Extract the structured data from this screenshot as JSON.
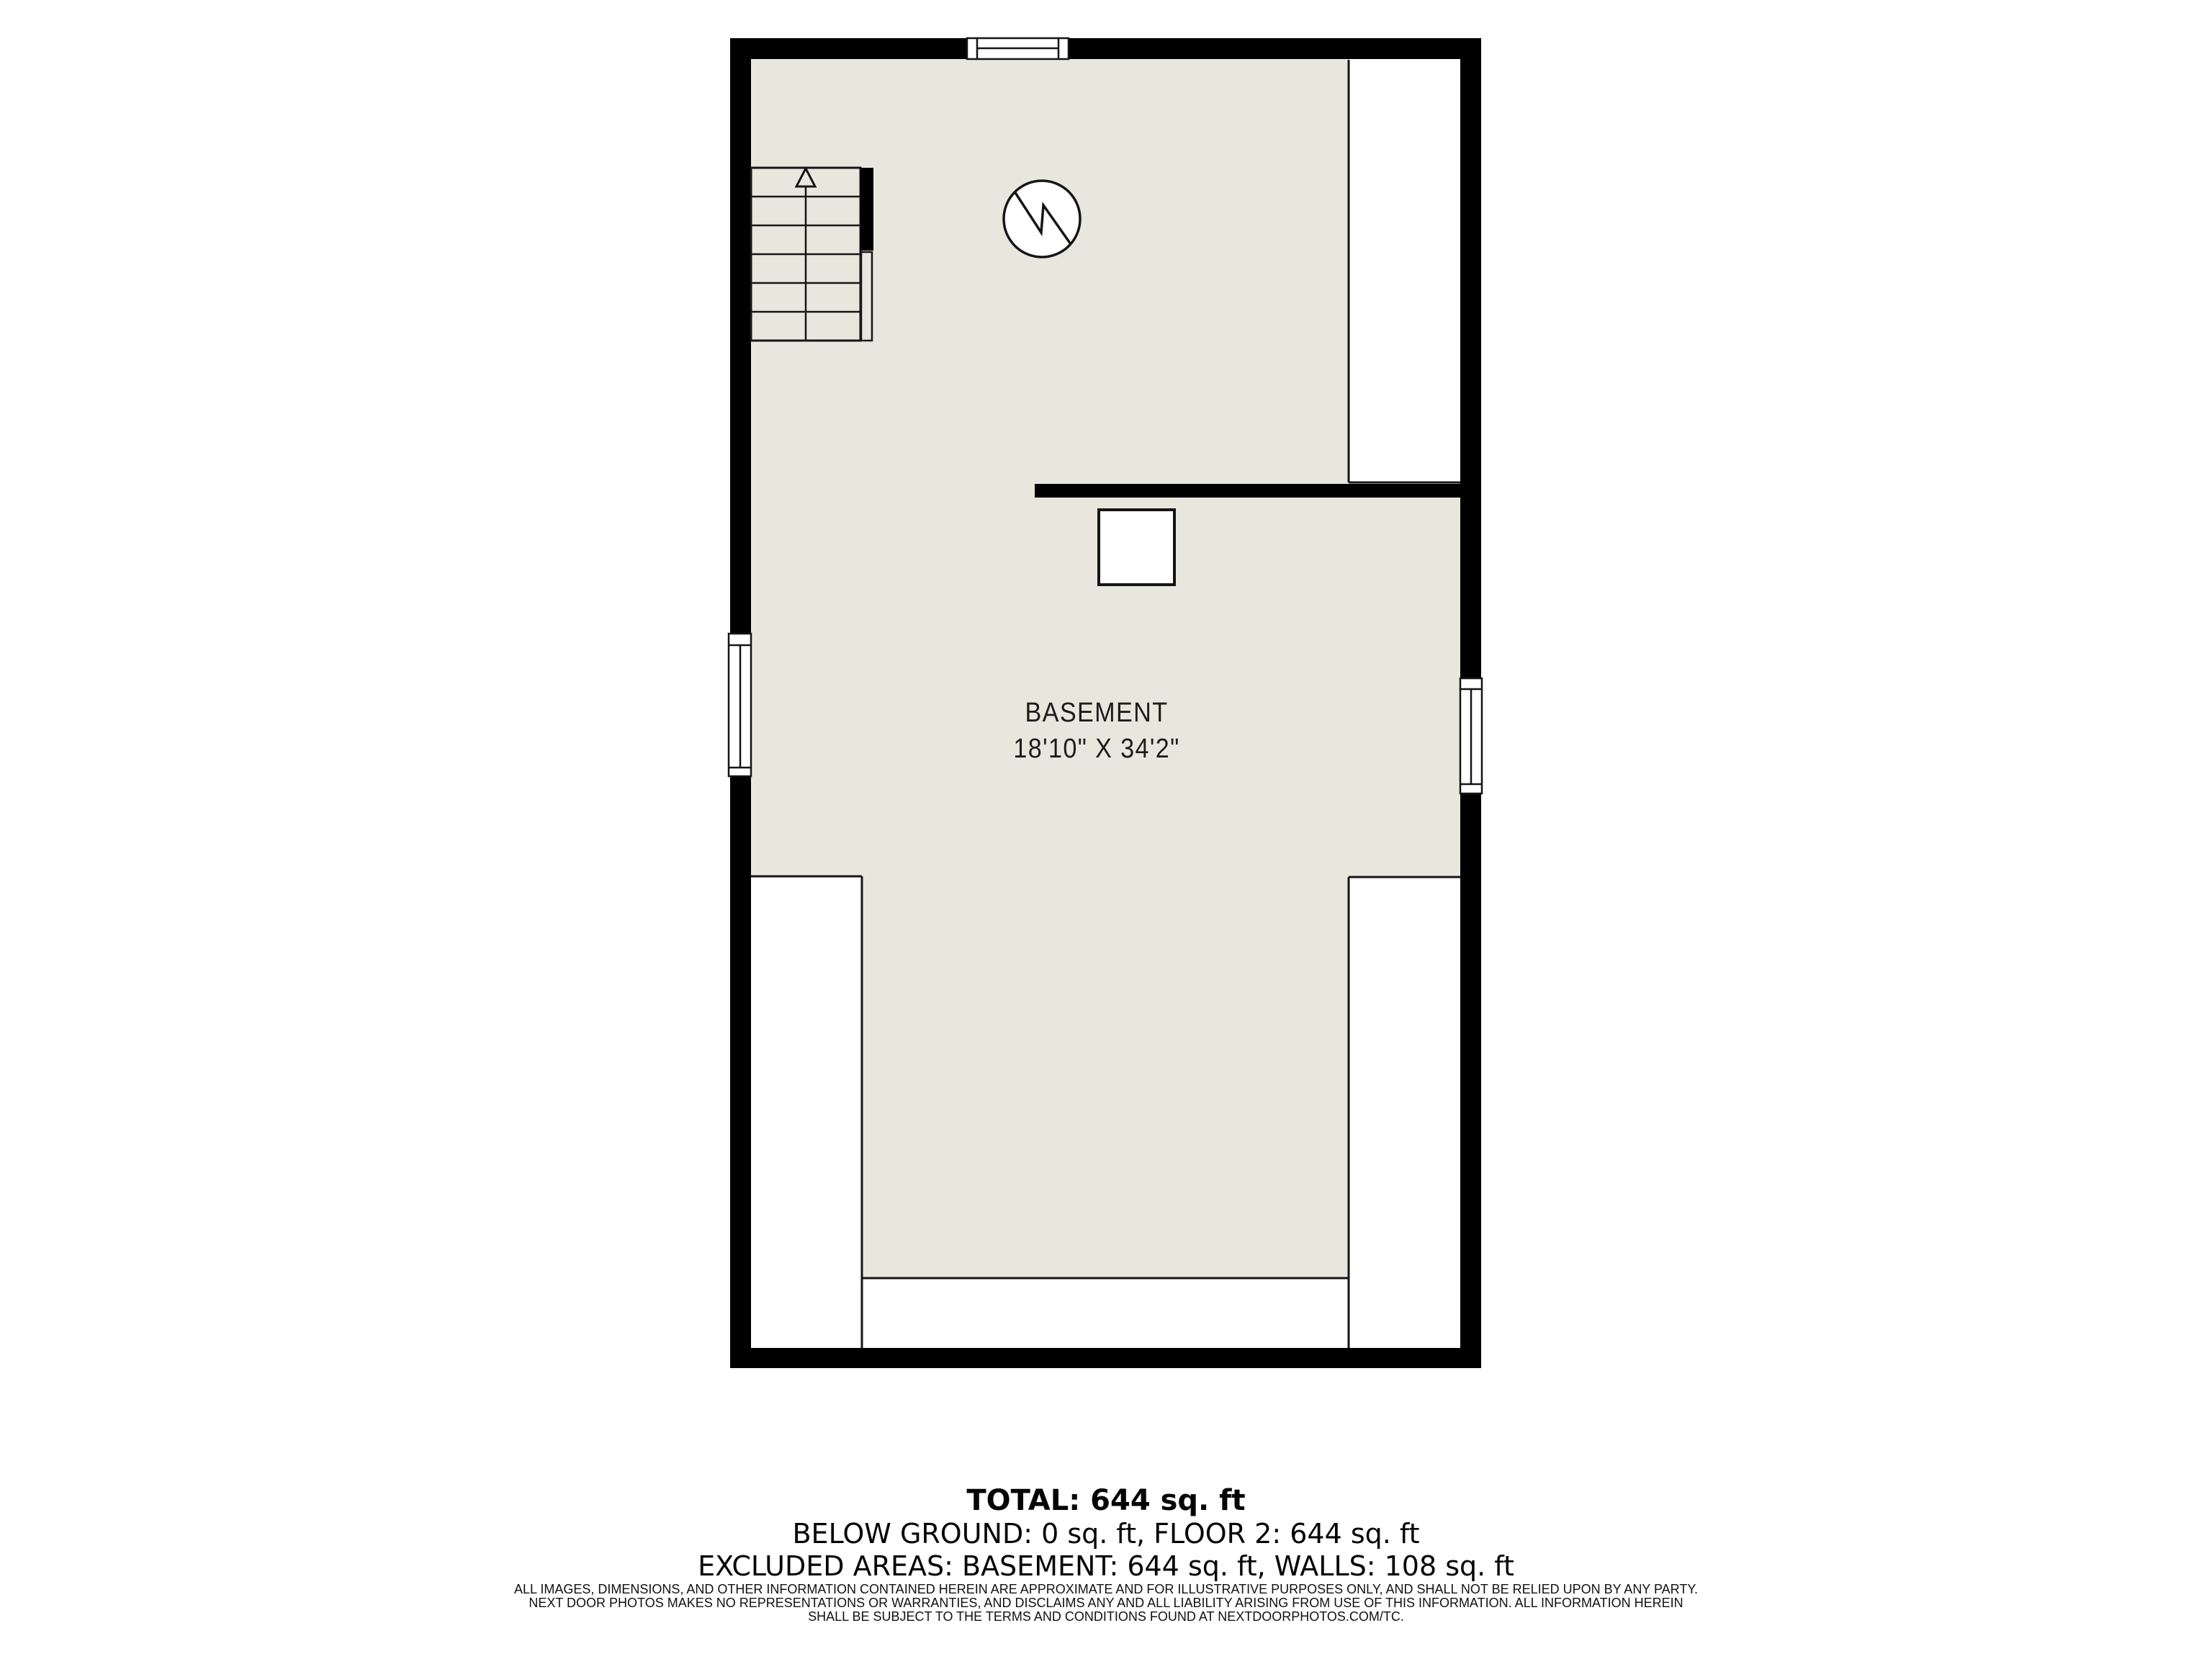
{
  "floorplan": {
    "room_label": "BASEMENT",
    "room_dimensions": "18'10\" X 34'2\"",
    "stair_direction": "up",
    "colors": {
      "background": "#ffffff",
      "floor": "#e8e7dd",
      "wall": "#000000",
      "thin_line": "#161616",
      "label_text": "#1c1c1c"
    }
  },
  "summary": {
    "total": "TOTAL: 644 sq. ft",
    "areas": "BELOW GROUND: 0 sq. ft, FLOOR 2: 644 sq. ft",
    "excluded": "EXCLUDED AREAS: BASEMENT: 644 sq. ft, WALLS: 108 sq. ft"
  },
  "disclaimer": {
    "line1": "ALL IMAGES, DIMENSIONS, AND OTHER INFORMATION CONTAINED HEREIN ARE APPROXIMATE AND FOR ILLUSTRATIVE PURPOSES ONLY, AND SHALL NOT BE RELIED UPON BY ANY PARTY.",
    "line2": "NEXT DOOR PHOTOS MAKES NO REPRESENTATIONS OR WARRANTIES, AND DISCLAIMS ANY AND ALL LIABILITY ARISING FROM USE OF THIS INFORMATION. ALL INFORMATION HEREIN",
    "line3": "SHALL BE SUBJECT TO THE TERMS AND CONDITIONS FOUND AT NEXTDOORPHOTOS.COM/TC."
  }
}
